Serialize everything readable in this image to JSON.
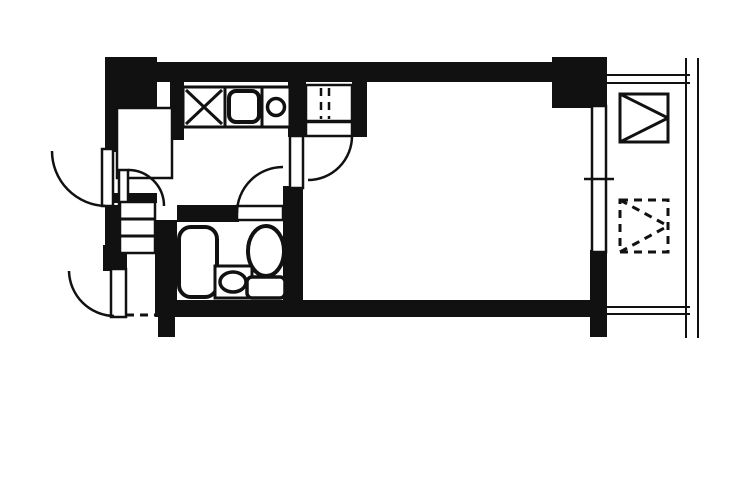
{
  "meta": {
    "title": "apartment-floor-plan",
    "canvas": {
      "width": 750,
      "height": 500
    },
    "colors": {
      "ink": "#111111",
      "background": "#ffffff"
    }
  },
  "plan": {
    "walls": [
      {
        "name": "wall-top-left-block",
        "r": [
          105,
          57,
          52,
          51
        ]
      },
      {
        "name": "wall-top",
        "r": [
          105,
          62,
          502,
          20
        ]
      },
      {
        "name": "wall-top-right-block",
        "r": [
          552,
          57,
          55,
          51
        ]
      },
      {
        "name": "wall-left-upper",
        "r": [
          105,
          80,
          20,
          72
        ]
      },
      {
        "name": "wall-left-mid",
        "r": [
          105,
          205,
          15,
          42
        ]
      },
      {
        "name": "wall-left-lower",
        "r": [
          103,
          245,
          24,
          26
        ]
      },
      {
        "name": "wall-ps-right",
        "r": [
          170,
          80,
          14,
          60
        ]
      },
      {
        "name": "wall-above-cabinet",
        "r": [
          105,
          193,
          52,
          10
        ]
      },
      {
        "name": "wall-hall-bath-divider",
        "r": [
          155,
          220,
          22,
          97
        ]
      },
      {
        "name": "wall-bath-top",
        "r": [
          177,
          205,
          62,
          17
        ]
      },
      {
        "name": "wall-bath-right",
        "r": [
          283,
          186,
          20,
          131
        ]
      },
      {
        "name": "wall-kitchen-right",
        "r": [
          288,
          80,
          18,
          57
        ]
      },
      {
        "name": "wall-closet-right-column",
        "r": [
          352,
          80,
          15,
          57
        ]
      },
      {
        "name": "wall-bottom",
        "r": [
          155,
          300,
          452,
          17
        ]
      },
      {
        "name": "wall-bottom-left-stub",
        "r": [
          158,
          317,
          17,
          20
        ]
      },
      {
        "name": "wall-window-right-column",
        "r": [
          590,
          250,
          17,
          87
        ]
      }
    ],
    "outlines": [
      {
        "name": "pipe-space-storage",
        "r": [
          117,
          108,
          55,
          70
        ],
        "rx": 0,
        "sw": 2.5
      },
      {
        "name": "refrigerator-space",
        "r": [
          183,
          87,
          42,
          40
        ],
        "rx": 0,
        "sw": 3
      },
      {
        "name": "kitchen-counter",
        "r": [
          225,
          87,
          65,
          40
        ],
        "rx": 0,
        "sw": 3
      },
      {
        "name": "kitchen-sink",
        "r": [
          229,
          91,
          30,
          31
        ],
        "rx": 7,
        "sw": 4
      },
      {
        "name": "front-closet",
        "r": [
          306,
          85,
          46,
          36
        ],
        "rx": 0,
        "sw": 2.5
      },
      {
        "name": "room-door-leaf",
        "r": [
          306,
          122,
          46,
          14
        ],
        "rx": 0,
        "sw": 2.5
      },
      {
        "name": "thin-partition-wall",
        "r": [
          290,
          136,
          13,
          52
        ],
        "rx": 0,
        "sw": 2.5
      },
      {
        "name": "bathroom-door-leaf",
        "r": [
          237,
          206,
          46,
          14
        ],
        "rx": 0,
        "sw": 2.5
      },
      {
        "name": "hall-door-leaf",
        "r": [
          119,
          170,
          9,
          37
        ],
        "rx": 0,
        "sw": 2.5
      },
      {
        "name": "service-door-leaf",
        "r": [
          102,
          149,
          11,
          57
        ],
        "rx": 0,
        "sw": 2.5
      },
      {
        "name": "entry-door-leaf",
        "r": [
          111,
          269,
          15,
          48
        ],
        "rx": 0,
        "sw": 2.5
      },
      {
        "name": "shoe-cabinet",
        "r": [
          120,
          202,
          35,
          51
        ],
        "rx": 0,
        "sw": 2.5
      },
      {
        "name": "bathtub",
        "r": [
          179,
          227,
          38,
          70
        ],
        "rx": 12,
        "sw": 4
      },
      {
        "name": "washbasin-counter",
        "r": [
          215,
          266,
          37,
          32
        ],
        "rx": 0,
        "sw": 3
      },
      {
        "name": "toilet-tank",
        "r": [
          247,
          277,
          38,
          21
        ],
        "rx": 5,
        "sw": 3.5
      },
      {
        "name": "balcony-window",
        "r": [
          592,
          106,
          14,
          146
        ],
        "rx": 0,
        "sw": 2.5
      },
      {
        "name": "balcony-unit-box",
        "r": [
          620,
          94,
          48,
          48
        ],
        "rx": 0,
        "sw": 3
      }
    ],
    "dashed_outlines": [
      {
        "name": "balcony-ac-space",
        "r": [
          620,
          200,
          48,
          52
        ],
        "sw": 3
      }
    ],
    "ellipses": [
      {
        "name": "stove-burner",
        "cx": 276,
        "cy": 107,
        "rx": 8.5,
        "ry": 8.5,
        "sw": 3.5
      },
      {
        "name": "washbasin-bowl",
        "cx": 233,
        "cy": 282,
        "rx": 13,
        "ry": 10,
        "sw": 3.5
      },
      {
        "name": "toilet-bowl",
        "cx": 266,
        "cy": 251,
        "rx": 18,
        "ry": 25,
        "sw": 4
      }
    ],
    "lines": [
      {
        "name": "refrigerator-cross-1",
        "p": [
          186,
          90,
          222,
          124
        ],
        "sw": 3
      },
      {
        "name": "refrigerator-cross-2",
        "p": [
          222,
          90,
          186,
          124
        ],
        "sw": 3
      },
      {
        "name": "counter-divider-1",
        "p": [
          225,
          87,
          225,
          127
        ],
        "sw": 3
      },
      {
        "name": "counter-divider-2",
        "p": [
          262,
          87,
          262,
          127
        ],
        "sw": 3
      },
      {
        "name": "shoe-cabinet-shelf-1",
        "p": [
          121,
          219,
          154,
          219
        ],
        "sw": 3
      },
      {
        "name": "shoe-cabinet-shelf-2",
        "p": [
          121,
          236,
          154,
          236
        ],
        "sw": 3
      },
      {
        "name": "window-tick",
        "p": [
          584,
          179,
          614,
          179
        ],
        "sw": 2.5
      },
      {
        "name": "balcony-box-diagonal-1",
        "p": [
          620,
          94,
          668,
          118
        ],
        "sw": 3
      },
      {
        "name": "balcony-box-diagonal-2",
        "p": [
          620,
          142,
          668,
          118
        ],
        "sw": 3
      },
      {
        "name": "balcony-top-line-1",
        "p": [
          607,
          75,
          690,
          75
        ],
        "sw": 2
      },
      {
        "name": "balcony-top-line-2",
        "p": [
          607,
          83,
          690,
          83
        ],
        "sw": 2
      },
      {
        "name": "balcony-bottom-line-1",
        "p": [
          607,
          307,
          690,
          307
        ],
        "sw": 2
      },
      {
        "name": "balcony-bottom-line-2",
        "p": [
          607,
          314,
          690,
          314
        ],
        "sw": 2
      },
      {
        "name": "balcony-railing-line-1",
        "p": [
          686,
          58,
          686,
          338
        ],
        "sw": 2
      },
      {
        "name": "balcony-railing-line-2",
        "p": [
          698,
          58,
          698,
          338
        ],
        "sw": 2
      }
    ],
    "dashed_lines": [
      {
        "name": "entry-threshold",
        "p": [
          126,
          315,
          157,
          315
        ],
        "sw": 3
      },
      {
        "name": "front-closet-dash-1",
        "p": [
          321,
          88,
          321,
          119
        ],
        "sw": 2.5
      },
      {
        "name": "front-closet-dash-2",
        "p": [
          329,
          88,
          329,
          119
        ],
        "sw": 2.5
      },
      {
        "name": "ac-space-diagonal-1",
        "p": [
          620,
          200,
          668,
          226
        ],
        "sw": 3
      },
      {
        "name": "ac-space-diagonal-2",
        "p": [
          620,
          252,
          668,
          226
        ],
        "sw": 3
      }
    ],
    "door_arcs": [
      {
        "name": "entry-door-swing",
        "d": "M 69 271 A 46 46 0 0 0 114 316",
        "sw": 2.5
      },
      {
        "name": "service-door-swing",
        "d": "M 52 151 A 55 55 0 0 0 106 206",
        "sw": 2.5
      },
      {
        "name": "hall-door-swing",
        "d": "M 128 170 A 36 36 0 0 1 164 206",
        "sw": 2.5
      },
      {
        "name": "bathroom-door-swing",
        "d": "M 237 213 A 46 46 0 0 1 283 167",
        "sw": 2.5
      },
      {
        "name": "room-door-swing",
        "d": "M 352 136 A 44 44 0 0 1 308 180",
        "sw": 2.5
      }
    ]
  }
}
